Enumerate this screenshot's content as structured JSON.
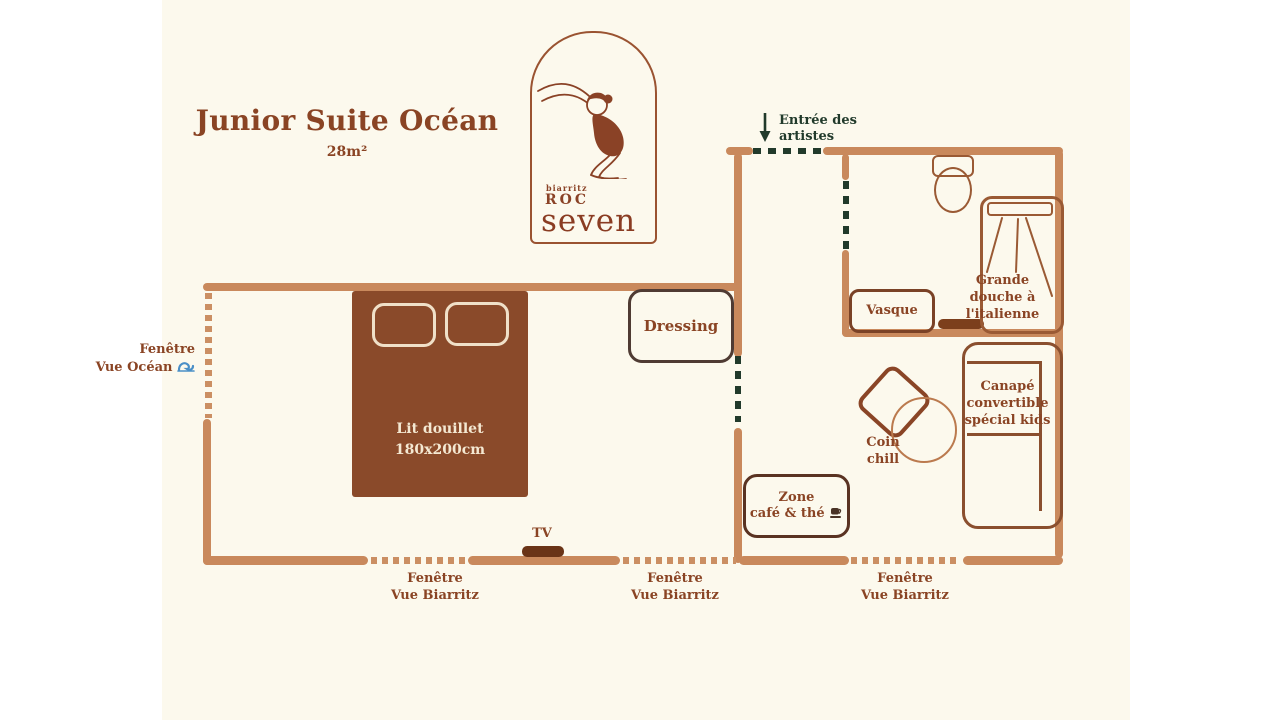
{
  "header": {
    "title": "Junior Suite Océan",
    "area": "28m²"
  },
  "logo": {
    "city": "biarritz",
    "brand_top": "ROC",
    "brand_bottom": "seven"
  },
  "entrance": {
    "line1": "Entrée des",
    "line2": "artistes"
  },
  "rooms": {
    "bed": {
      "line1": "Lit douillet",
      "line2": "180x200cm"
    },
    "dressing": "Dressing",
    "vasque": "Vasque",
    "shower": {
      "line1": "Grande",
      "line2": "douche à",
      "line3": "l'italienne"
    },
    "sofa": {
      "line1": "Canapé",
      "line2": "convertible",
      "line3": "spécial kids"
    },
    "chill": {
      "line1": "Coin",
      "line2": "chill"
    },
    "coffee": {
      "line1": "Zone",
      "line2": "café & thé"
    },
    "tv": "TV"
  },
  "windows": {
    "ocean": {
      "line1": "Fenêtre",
      "line2": "Vue Océan"
    },
    "biarritz": {
      "line1": "Fenêtre",
      "line2": "Vue Biarritz"
    }
  },
  "icons": {
    "wave": "wave-icon",
    "coffee_cup": "coffee-cup-icon",
    "entrance_arrow": "down-arrow-icon"
  },
  "colors": {
    "page_background": "#ffffff",
    "plan_background": "#fcf9ed",
    "wall_tan": "#c9895c",
    "accent_brown": "#8a4424",
    "bed_fill": "#8a4a2a",
    "bed_text": "#f4e8d2",
    "door_dash_green": "#213a2b",
    "tv_fill": "#6a3417",
    "wave_blue": "#4a8fc7"
  }
}
